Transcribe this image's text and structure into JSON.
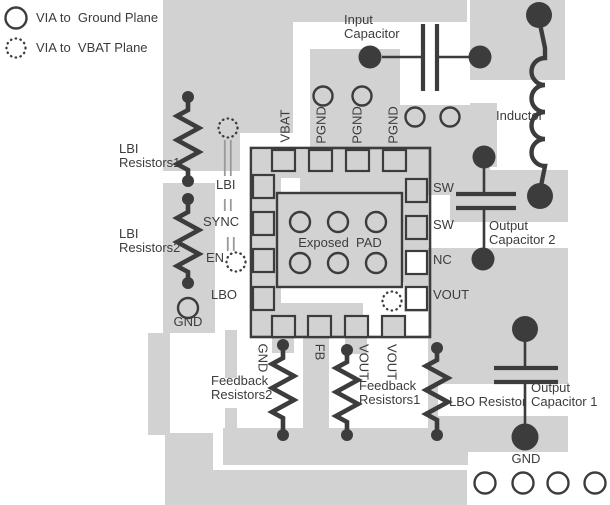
{
  "colors": {
    "pour": "#d2d2d2",
    "line": "#3c3c3c"
  },
  "legend": {
    "ground": "VIA to  Ground Plane",
    "vbat": "VIA to  VBAT Plane"
  },
  "ic": {
    "exposed_pad": "Exposed  PAD",
    "pads_top": [
      "VBAT",
      "PGND",
      "PGND",
      "PGND"
    ],
    "pads_left": [
      "LBI",
      "SYNC",
      "EN",
      "LBO"
    ],
    "pads_right": [
      "SW",
      "SW",
      "NC",
      "VOUT"
    ],
    "pads_bottom": [
      "GND",
      "FB",
      "VOUT",
      "VOUT"
    ]
  },
  "components": {
    "input_capacitor": "Input\nCapacitor",
    "inductor": "Inductor",
    "output_capacitor_2": "Output\nCapacitor 2",
    "output_capacitor_1": "Output\nCapacitor 1",
    "lbi_resistors_1": "LBI\nResistors1",
    "lbi_resistors_2": "LBI\nResistors2",
    "feedback_resistors_2": "Feedback\nResistors2",
    "feedback_resistors_1": "Feedback\nResistors1",
    "lbo_resistor": "LBO Resistor",
    "gnd_left": "GND",
    "gnd_bottom": "GND"
  }
}
